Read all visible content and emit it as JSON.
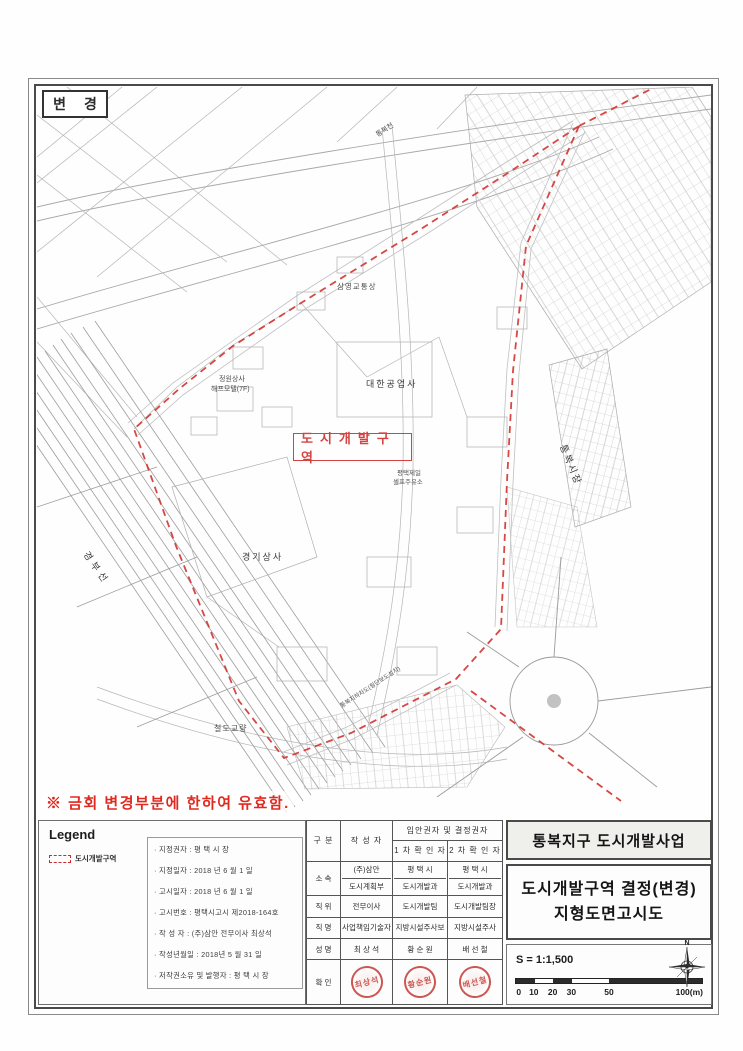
{
  "page": {
    "change_label": "변 경",
    "validity_note": "※ 금회 변경부분에 한하여 유효함."
  },
  "map": {
    "zone_box_label": "도시개발구역",
    "labels": {
      "stream": "통복천",
      "bus": "삼영교통상",
      "daehan": "대한공업사",
      "jeongwon": "정원상사",
      "motel": "해프모텔(7F)",
      "gyeonggi": "경기상사",
      "gas1": "평택제일",
      "gas2": "셀프주유소",
      "railway": "경부선",
      "market": "통복시장",
      "bridge": "철도교량",
      "underpass": "통복지하차도(횡단보도설치)"
    },
    "colors": {
      "boundary_red": "#d23430",
      "line_gray": "#b0b0b0"
    }
  },
  "legend": {
    "title": "Legend",
    "item_label": "도시개발구역"
  },
  "info": {
    "lines": [
      "· 지정권자 : 평 택 시 장",
      "· 지정일자 : 2018 년  6 월  1 일",
      "· 고시일자 : 2018 년  6 월  1 일",
      "· 고시번호 : 평택시고시 제2018-164호",
      "· 작 성 자 : (주)삼안 전무이사 최상석",
      "· 작성년월일 : 2018년  5 월  31 일",
      "· 저작권소유 및 발행자 : 평 택 시 장"
    ]
  },
  "staff": {
    "h_gubun": "구 분",
    "h_author": "작 성 자",
    "h_span": "입안권자 및 결정권자",
    "h_c1": "1 차 확 인 자",
    "h_c2": "2 차 확 인 자",
    "sosok_label": "소 속",
    "sosok_a1": "(주)삼안",
    "sosok_a2": "도시계획부",
    "sosok_b1": "평 택 시",
    "sosok_b2": "도시개발과",
    "sosok_c1": "평 택 시",
    "sosok_c2": "도시개발과",
    "jigwi_label": "직 위",
    "jigwi_a": "전무이사",
    "jigwi_b": "도시개발팀",
    "jigwi_c": "도시개발팀장",
    "jikmyeong_label": "직 명",
    "jikmyeong_a": "사업책임기술자",
    "jikmyeong_b": "지방시설주사보",
    "jikmyeong_c": "지방시설주사",
    "name_label": "성 명",
    "name_a": "최 상 석",
    "name_b": "황 순 원",
    "name_c": "배 선 철",
    "hwakin_label": "확 인",
    "stamp_a": "최상석",
    "stamp_b": "황순원",
    "stamp_c": "배선철"
  },
  "title": {
    "project": "통복지구 도시개발사업",
    "doc_line1": "도시개발구역 결정(변경)",
    "doc_line2": "지형도면고시도"
  },
  "scale": {
    "ratio": "S = 1:1,500",
    "ticks": [
      "0",
      "10",
      "20",
      "30",
      "50",
      "100(m)"
    ],
    "compass_n": "N"
  }
}
